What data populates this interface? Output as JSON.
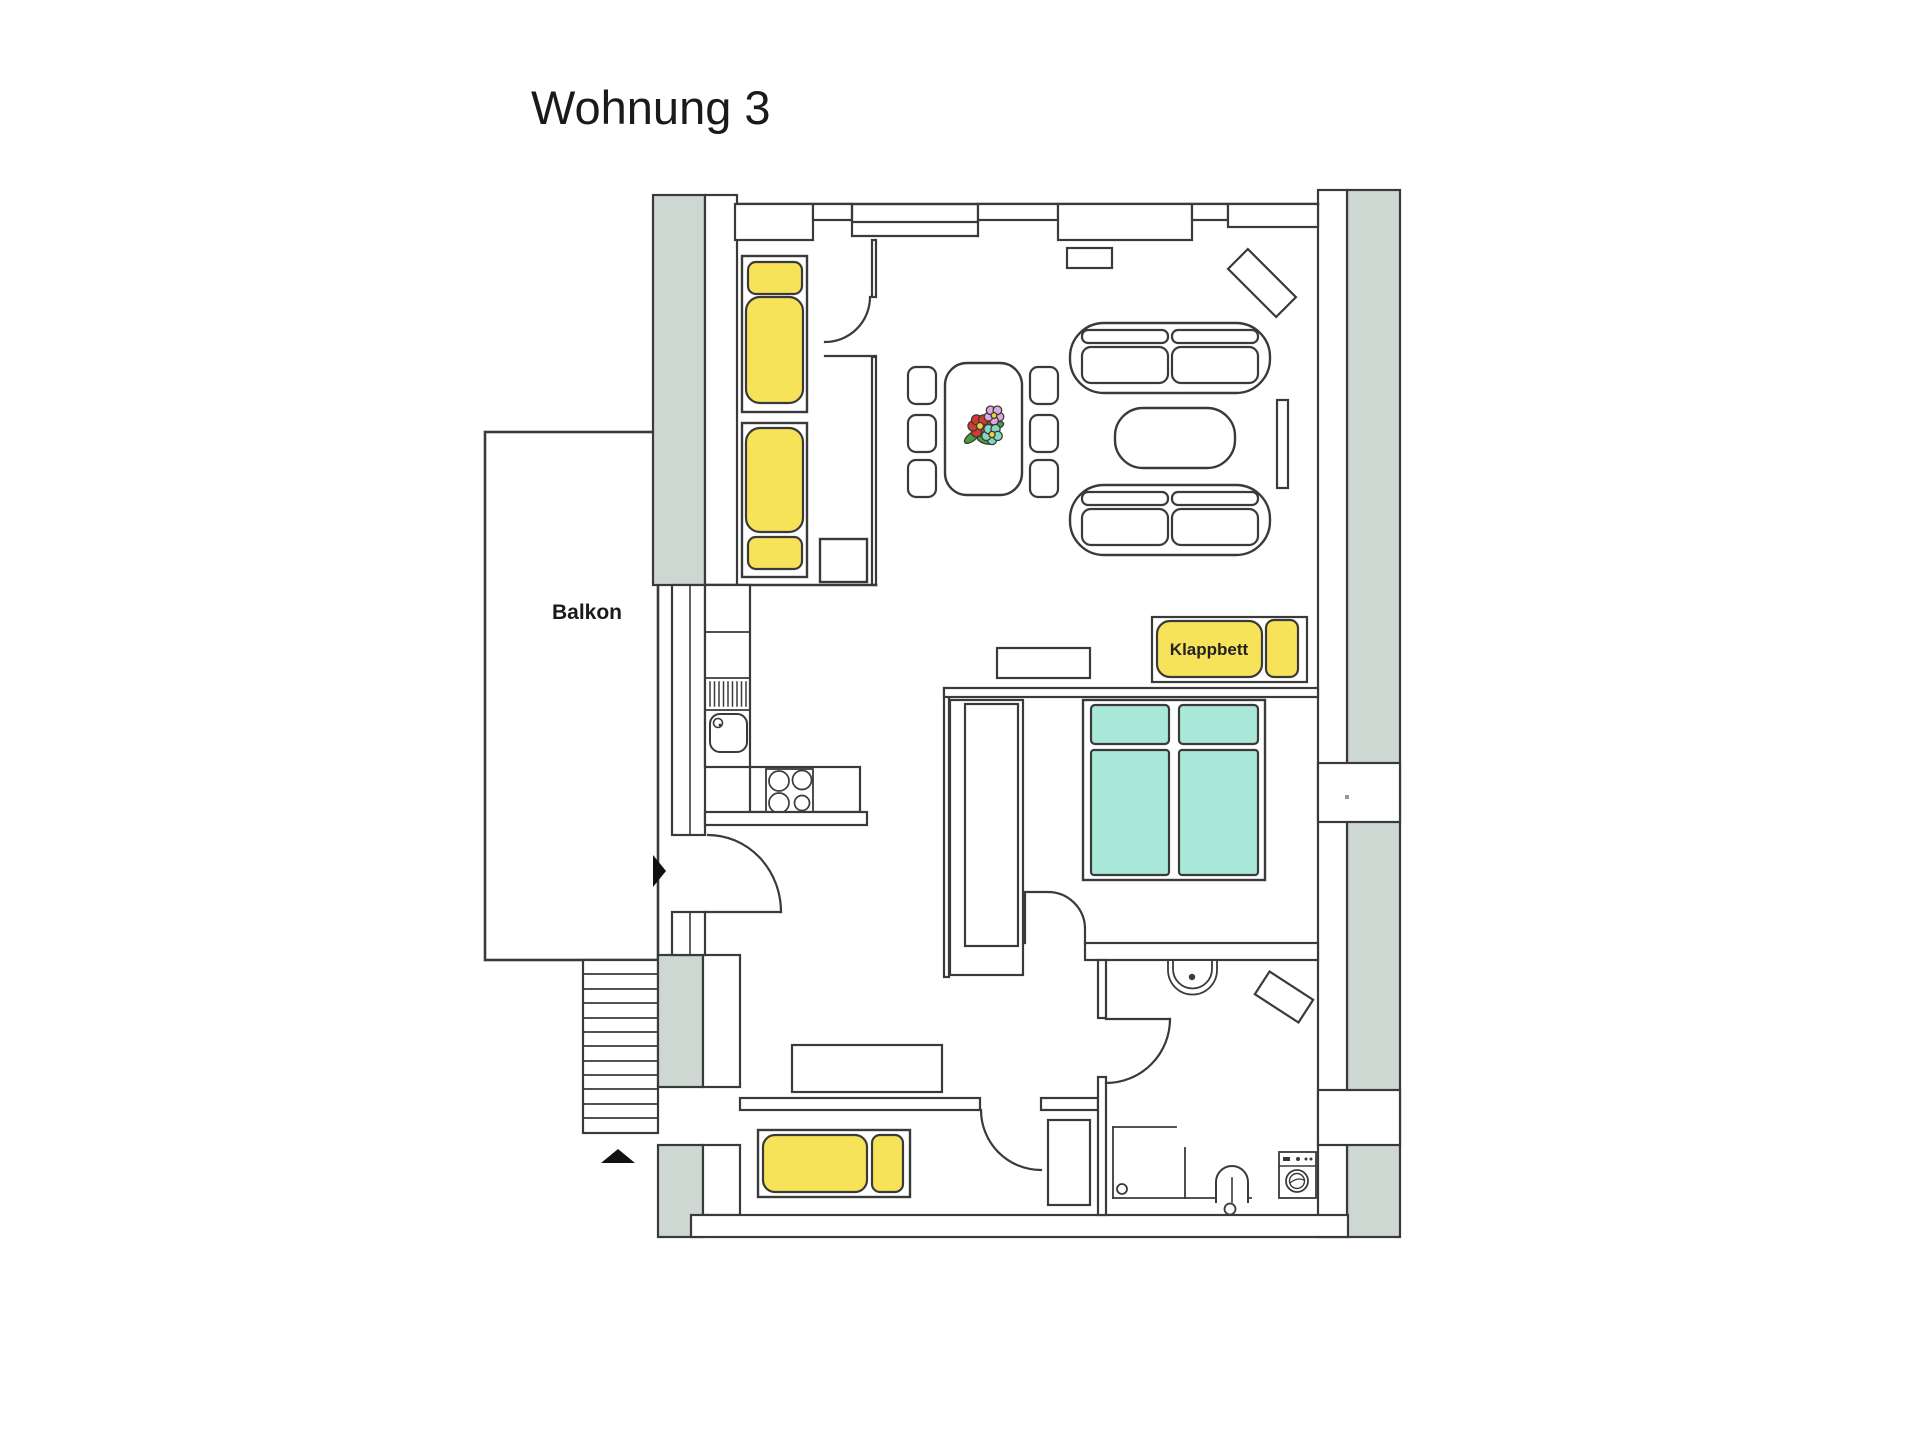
{
  "title": "Wohnung 3",
  "labels": {
    "balcony": "Balkon",
    "folding_bed": "Klappbett"
  },
  "colors": {
    "outline": "#3a3a3a",
    "text": "#1a1a1a",
    "wall_band": "#ccd8d1",
    "furniture_yellow": "#f7e35a",
    "bed_teal": "#a9e8d8",
    "arrow_black": "#111111",
    "flower_red": "#d23b2e",
    "flower_pink": "#dca8e0",
    "flower_teal": "#83d9bb",
    "flower_center": "#f2cf3a",
    "leaf_green": "#4a9f3f",
    "wall_dot": "#999999"
  }
}
